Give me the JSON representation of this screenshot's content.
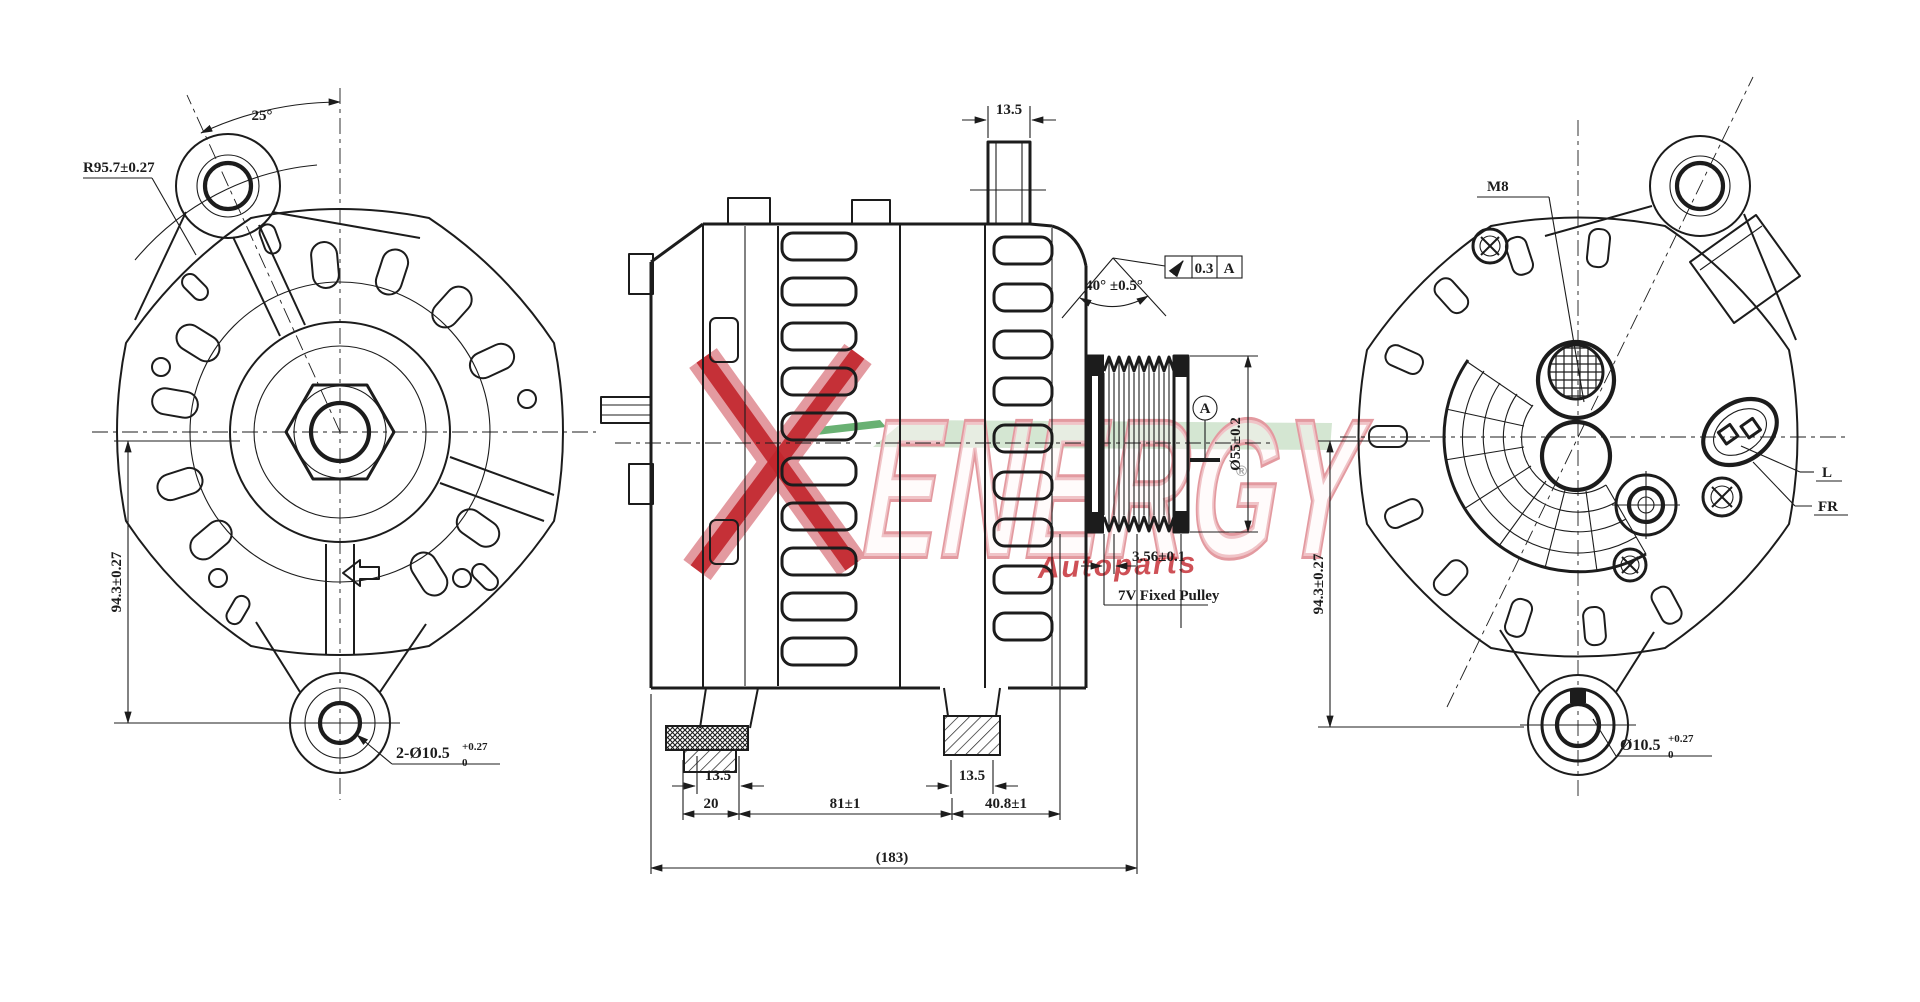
{
  "front_view": {
    "angle": "25°",
    "radius": "R95.7±0.27",
    "height": "94.3±0.27",
    "holes": "2-Ø10.5",
    "holes_tol_plus": "+0.27",
    "holes_tol_minus": "0"
  },
  "side_view": {
    "stud_width": "13.5",
    "groove_angle": "40° ±0.5°",
    "fcf_value": "0.3",
    "fcf_datum": "A",
    "pulley_dia": "Ø55±0.2",
    "datum": "A",
    "groove_pitch": "3.56±0.1",
    "pulley_note": "7V Fixed Pulley",
    "foot_left_width": "13.5",
    "foot_right_width": "13.5",
    "dim_foot_offset": "20",
    "dim_feet_span": "81±1",
    "dim_front_span": "40.8±1",
    "dim_overall": "(183)"
  },
  "rear_view": {
    "thread": "M8",
    "terminal_l": "L",
    "terminal_fr": "FR",
    "height": "94.3±0.27",
    "hole": "Ø10.5",
    "hole_tol_plus": "+0.27",
    "hole_tol_minus": "0"
  },
  "watermark": {
    "x_letter": "X",
    "name": "ENERGY",
    "registered": "®",
    "sub": "Autoparts",
    "colors": {
      "red": "#c2252c",
      "pink": "#e39aa0",
      "green_light": "#cfe3cd",
      "green_dark": "#4fa35a"
    }
  }
}
